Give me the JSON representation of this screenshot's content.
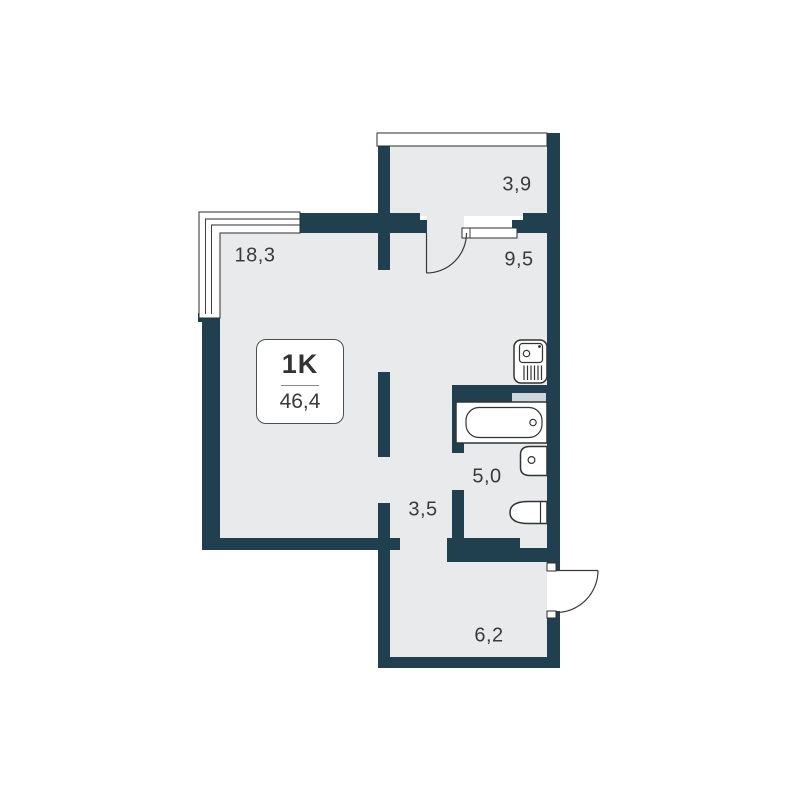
{
  "colors": {
    "bg": "#ffffff",
    "wall": "#204050",
    "floor": "#e9eaeb",
    "shaft": "#cdd6dc",
    "outline": "#2e2e2e",
    "text": "#3a3a3a"
  },
  "plan": {
    "unit": {
      "type_label": "1K",
      "total_area": "46,4"
    },
    "rooms": [
      {
        "name": "living-room",
        "area": "18,3"
      },
      {
        "name": "balcony",
        "area": "3,9"
      },
      {
        "name": "hallway",
        "area": "9,5"
      },
      {
        "name": "bathroom",
        "area": "5,0"
      },
      {
        "name": "corridor",
        "area": "3,5"
      },
      {
        "name": "entry-hall",
        "area": "6,2"
      }
    ],
    "fixtures": [
      "kitchen-sink",
      "bathtub",
      "washbasin",
      "toilet"
    ],
    "doors": [
      "balcony-door",
      "entrance-door"
    ],
    "windows": [
      "living-room-window",
      "balcony-glazing"
    ]
  }
}
